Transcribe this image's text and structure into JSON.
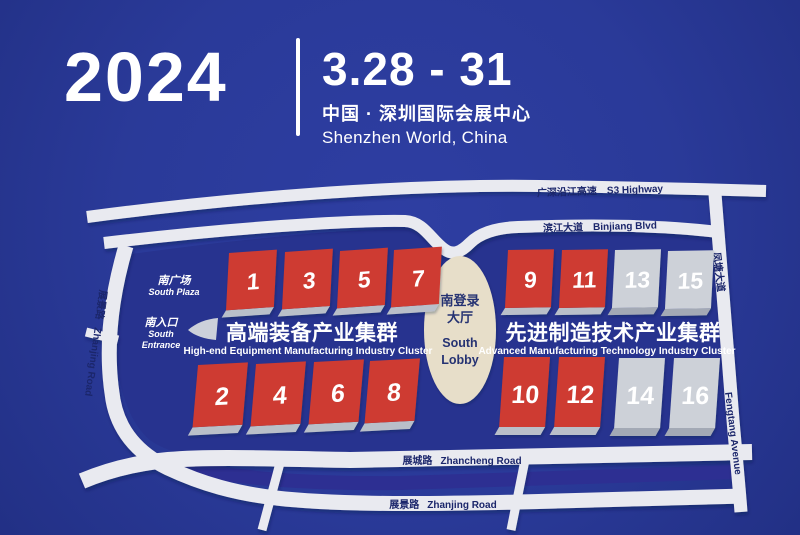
{
  "header": {
    "year": "2024",
    "dates": "3.28 - 31",
    "venue_cn": "中国 · 深圳国际会展中心",
    "venue_en": "Shenzhen World, China"
  },
  "map": {
    "roads": {
      "s3": {
        "cn": "广深沿江高速",
        "en": "S3 Highway"
      },
      "binjiang": {
        "cn": "滨江大道",
        "en": "Binjiang Blvd"
      },
      "fengtang": {
        "cn": "凤塘大道",
        "en": "Fengtang Avenue"
      },
      "zhancheng": {
        "cn": "展城路",
        "en": "Zhancheng Road"
      },
      "zhanjing": {
        "cn": "展景路",
        "en": "Zhanjing Road"
      },
      "zhanjing_west": {
        "cn": "展景路",
        "en": "Zhanjing Road"
      }
    },
    "labels": {
      "south_plaza_cn": "南广场",
      "south_plaza_en": "South Plaza",
      "south_entrance_cn": "南入口",
      "south_entrance_en1": "South",
      "south_entrance_en2": "Entrance",
      "lobby_cn1": "南登录",
      "lobby_cn2": "大厅",
      "lobby_en1": "South",
      "lobby_en2": "Lobby"
    },
    "clusters": [
      {
        "cn": "高端装备产业集群",
        "en": "High-end Equipment Manufacturing Industry Cluster"
      },
      {
        "cn": "先进制造技术产业集群",
        "en": "Advanced Manufacturing Technology Industry Cluster"
      }
    ],
    "halls": [
      {
        "number": "1",
        "type": "red"
      },
      {
        "number": "3",
        "type": "red"
      },
      {
        "number": "5",
        "type": "red"
      },
      {
        "number": "7",
        "type": "red"
      },
      {
        "number": "2",
        "type": "red"
      },
      {
        "number": "4",
        "type": "red"
      },
      {
        "number": "6",
        "type": "red"
      },
      {
        "number": "8",
        "type": "red"
      },
      {
        "number": "9",
        "type": "red"
      },
      {
        "number": "11",
        "type": "red"
      },
      {
        "number": "13",
        "type": "gray"
      },
      {
        "number": "15",
        "type": "gray"
      },
      {
        "number": "10",
        "type": "red"
      },
      {
        "number": "12",
        "type": "red"
      },
      {
        "number": "14",
        "type": "gray"
      },
      {
        "number": "16",
        "type": "gray"
      }
    ]
  },
  "colors": {
    "background": "#2a3a99",
    "site": "#27338f",
    "road": "#e9eaf0",
    "canal": "#2d2f92",
    "hall_red": "#ce3a31",
    "hall_gray": "#cdd1d8",
    "lobby": "#e7dec9",
    "text_white": "#ffffff",
    "road_text": "#1b266b"
  }
}
